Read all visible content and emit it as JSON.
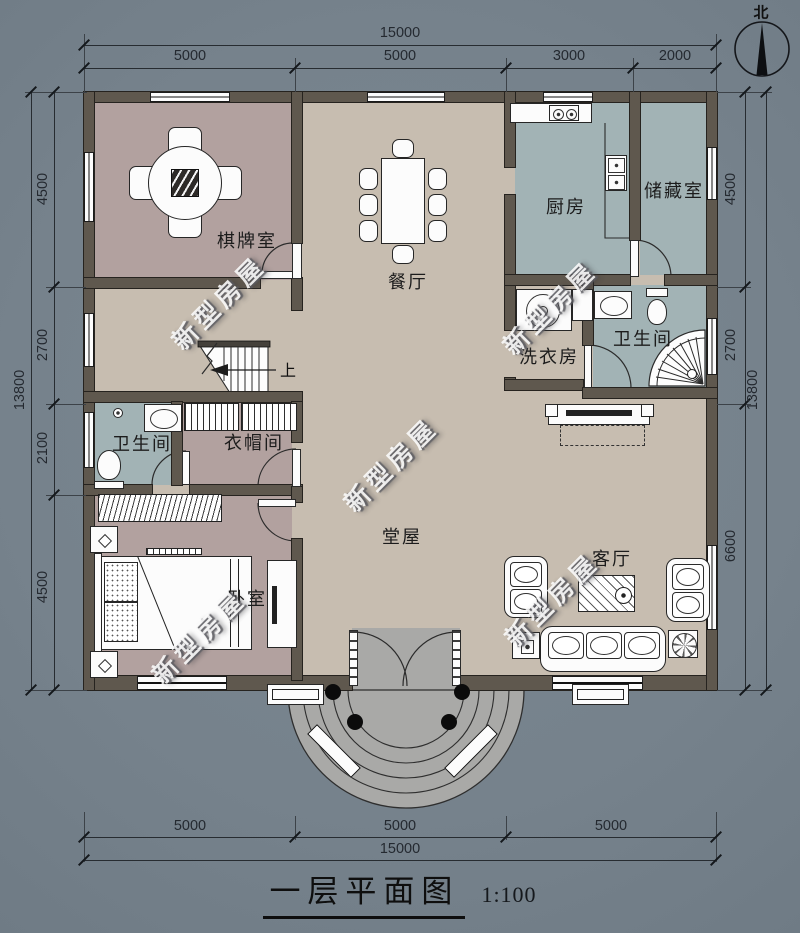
{
  "plan": {
    "title": "一层平面图",
    "scale": "1:100",
    "north": "北",
    "up": "上",
    "watermark": "新型房屋",
    "rooms": {
      "chess": "棋牌室",
      "dining": "餐厅",
      "kitchen": "厨房",
      "storage": "储藏室",
      "bath_right": "卫生间",
      "laundry": "洗衣房",
      "bath_left": "卫生间",
      "cloakroom": "衣帽间",
      "bedroom": "卧室",
      "hall": "堂屋",
      "living": "客厅"
    },
    "dims": {
      "top_total": "15000",
      "top_segments": [
        "5000",
        "5000",
        "3000",
        "2000"
      ],
      "bottom_total": "15000",
      "bottom_segments": [
        "5000",
        "5000",
        "5000"
      ],
      "left_total": "13800",
      "left_segments": [
        "4500",
        "2700",
        "2100",
        "4500"
      ],
      "right_total": "13800",
      "right_segments": [
        "4500",
        "2700",
        "6600"
      ]
    },
    "colors": {
      "background": "#76828c",
      "floor_beige": "#c7bdb0",
      "room_mauve": "#b2a19f",
      "room_teal": "#a2b3b5",
      "wall": "#5f584e",
      "steps": "#a9a9a7"
    }
  }
}
